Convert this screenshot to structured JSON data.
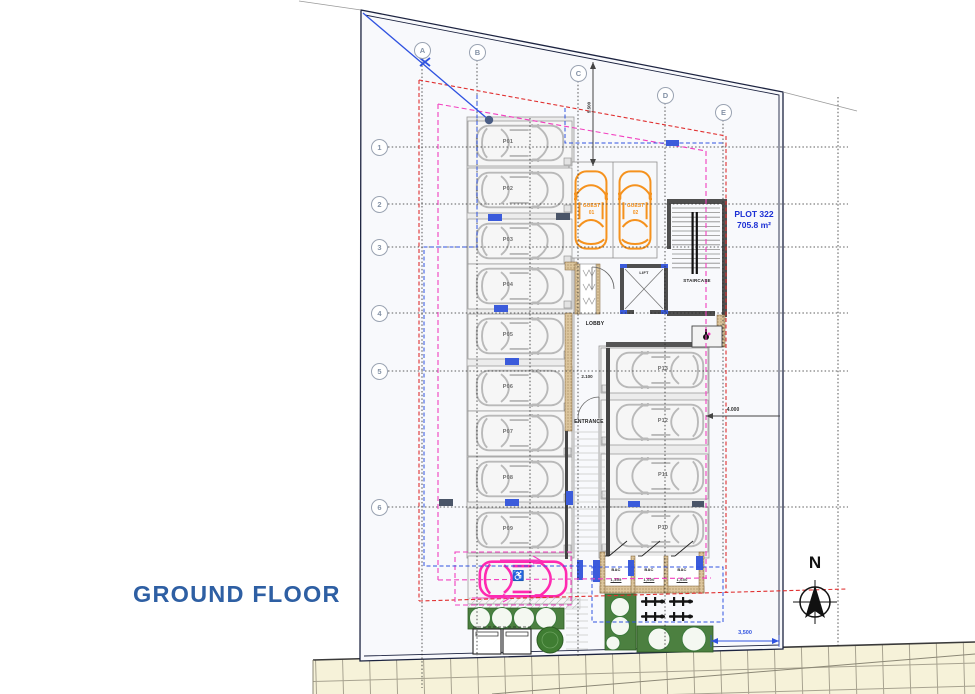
{
  "title": "GROUND FLOOR",
  "north_label": "N",
  "plot": {
    "name": "PLOT 322",
    "area": "705.8 m²"
  },
  "grid": {
    "columns": [
      "A",
      "B",
      "C",
      "D",
      "E"
    ],
    "rows": [
      "1",
      "2",
      "3",
      "4",
      "5",
      "6"
    ]
  },
  "rooms": {
    "lobby": "LOBBY",
    "lift": "LIFT",
    "staircase": "STAIRCASE",
    "entrance": "ENTRANCE"
  },
  "parking": {
    "left": [
      "P01",
      "P02",
      "P03",
      "P04",
      "P05",
      "P06",
      "P07",
      "P08",
      "P09"
    ],
    "right": [
      "P13",
      "P12",
      "P11",
      "P10"
    ],
    "guests": [
      {
        "name": "GUEST",
        "number": "01"
      },
      {
        "name": "GUEST",
        "number": "02"
      }
    ],
    "accessible_symbol": "♿"
  },
  "storage": [
    {
      "label": "BAC",
      "dim": "1,355"
    },
    {
      "label": "BAC",
      "dim": "1,600"
    },
    {
      "label": "BAC",
      "dim": "1,650"
    }
  ],
  "dimensions": {
    "boundary_to_building": "5.500",
    "building_to_boundary": "4.000",
    "pavement": "3,500",
    "entrance_width": "2.100"
  },
  "colors": {
    "accent_blue": "#2f52e0",
    "plot_blue": "#1b2fd4",
    "title_blue": "#2e5fa3",
    "guest_orange": "#f5921e",
    "accessible_pink": "#ff29b0",
    "setback_red": "#e03030",
    "setback_magenta": "#f23fbf",
    "landscape_green": "#4c8040"
  }
}
